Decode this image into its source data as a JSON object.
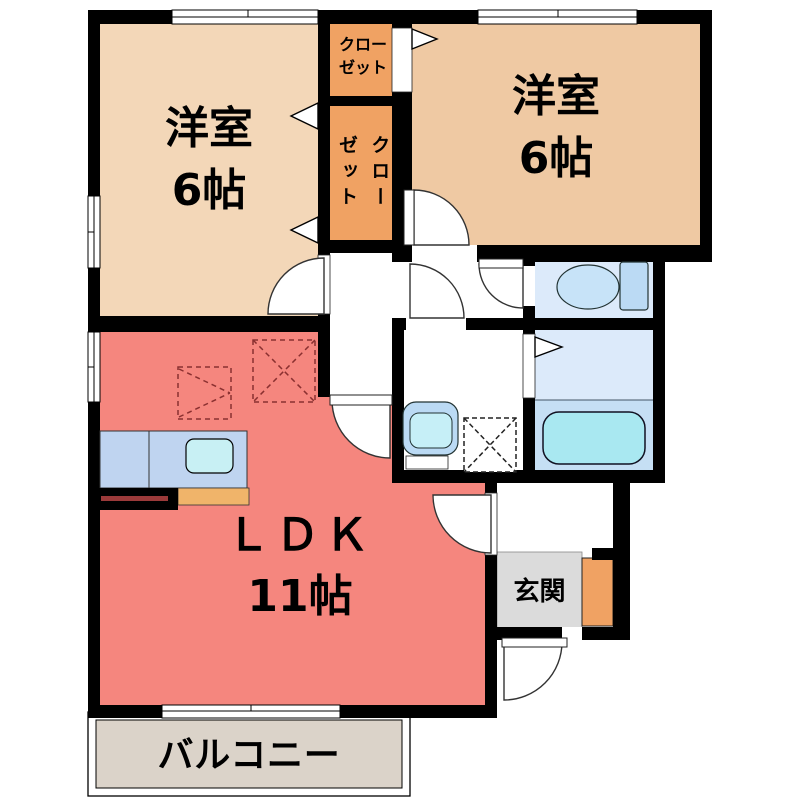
{
  "floor_plan": {
    "title": "apartment-floor-plan",
    "rooms": {
      "bedroom_top_left": {
        "name": "洋室",
        "size": "6帖"
      },
      "bedroom_top_right": {
        "name": "洋室",
        "size": "6帖"
      },
      "ldk": {
        "name": "ＬＤＫ",
        "size": "11帖"
      },
      "entrance": {
        "name": "玄関"
      },
      "balcony": {
        "name": "バルコニー"
      },
      "closet_upper": {
        "line1": "クロー",
        "line2": "ゼット"
      },
      "closet_side": {
        "line1": "クロー",
        "line2": "ゼット"
      }
    },
    "colors": {
      "wall": "#000000",
      "bedroom_left_floor": "#F3D7B8",
      "bedroom_right_floor": "#EFC9A3",
      "closet_floor": "#F0A263",
      "ldk_floor": "#F5867E",
      "wet_room_floor": "#DCEAFA",
      "bath_floor": "#C5DFF4",
      "bathtub": "#A9E8F1",
      "sink": "#C8F0F4",
      "fixture_blue": "#BBDAF4",
      "counter_blue": "#BFD4F0",
      "kitchen_orange": "#F0B46A",
      "entrance_floor": "#DBDBDB",
      "balcony_floor": "#DBD3C9",
      "dashed_marker": "#8A3030"
    },
    "icons": {
      "toilet": "toilet-icon",
      "bathtub": "bathtub-icon",
      "washbasin": "washbasin-icon",
      "washing_machine": "washing-machine-space-icon",
      "kitchen_sink": "kitchen-sink-icon",
      "door_swing": "door-swing-arc",
      "window": "window-glyph",
      "door_direction": "door-direction-arrow"
    }
  }
}
